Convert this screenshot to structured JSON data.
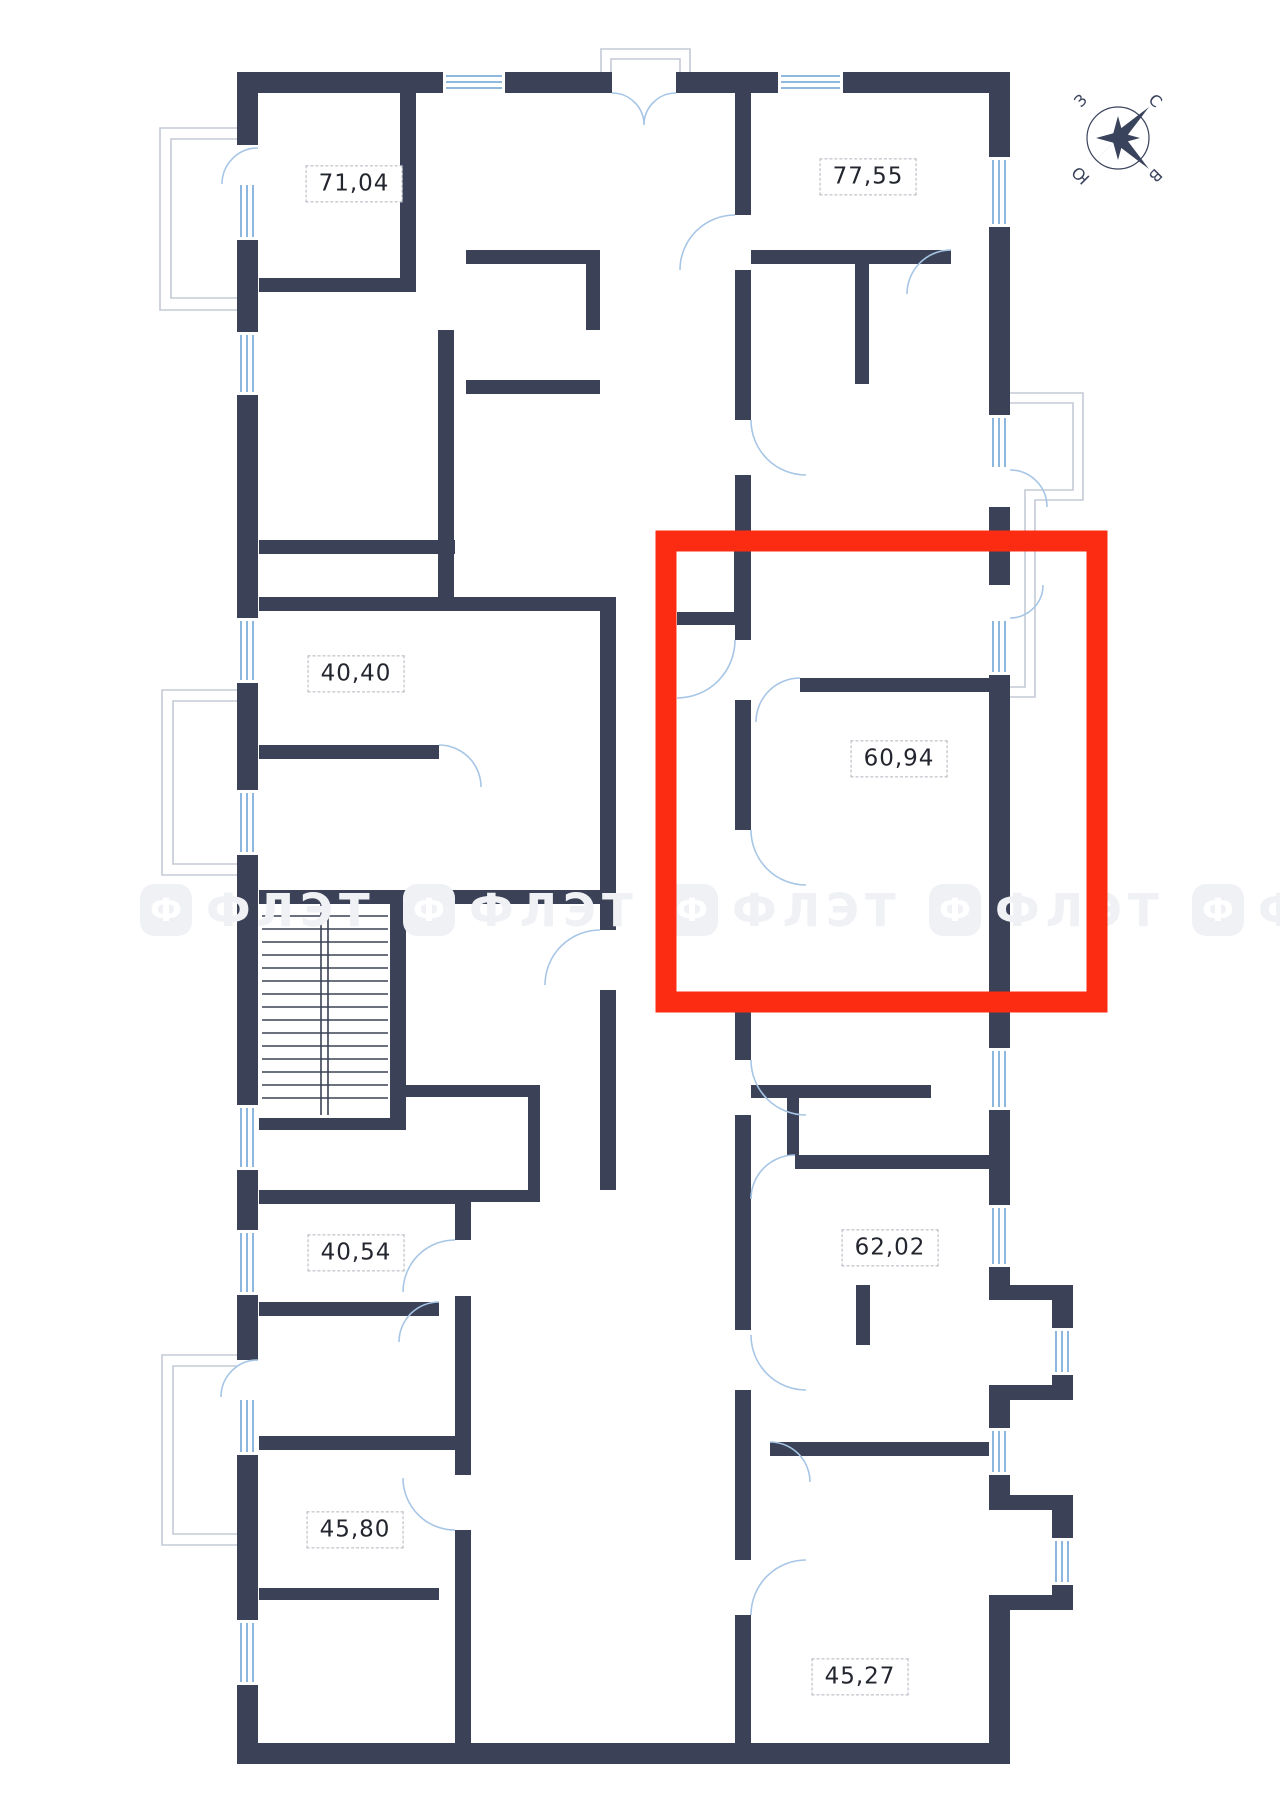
{
  "plan": {
    "title_hint": "floor-plan",
    "area_labels": [
      {
        "id": "apt-71-04",
        "value": "71,04"
      },
      {
        "id": "apt-77-55",
        "value": "77,55"
      },
      {
        "id": "apt-40-40",
        "value": "40,40"
      },
      {
        "id": "apt-60-94",
        "value": "60,94"
      },
      {
        "id": "apt-40-54",
        "value": "40,54"
      },
      {
        "id": "apt-62-02",
        "value": "62,02"
      },
      {
        "id": "apt-45-80",
        "value": "45,80"
      },
      {
        "id": "apt-45-27",
        "value": "45,27"
      }
    ],
    "highlight": {
      "apartment_area": "60,94",
      "color": "#fb2c12"
    }
  },
  "compass": {
    "north": "С",
    "east": "В",
    "south": "Ю",
    "west": "З"
  },
  "watermark": {
    "brand": "ФЛЭТ",
    "logo_letter": "Ф",
    "repeat": 5
  },
  "colors": {
    "wall": "#3b4257",
    "window_line": "#7fafda",
    "door_arc": "#a7c6e6",
    "balcony_outline": "#c3cad5",
    "highlight_red": "#fb2c12",
    "label_text": "#23262e",
    "watermark_gray": "#eef0f3",
    "compass_ink": "#3a435c"
  }
}
